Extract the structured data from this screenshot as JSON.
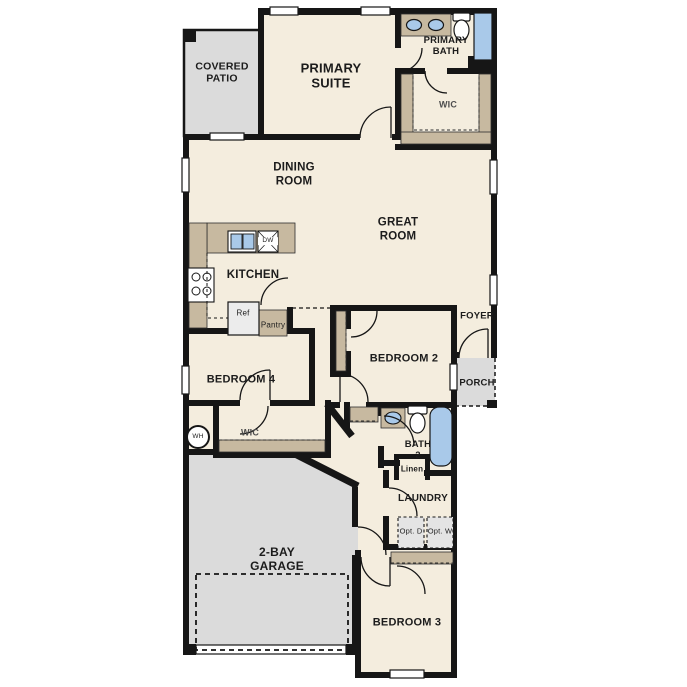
{
  "plan": {
    "title": "single-story-floor-plan",
    "rooms": {
      "covered_patio": "COVERED PATIO",
      "primary_suite": "PRIMARY SUITE",
      "primary_bath": "PRIMARY BATH",
      "primary_wic": "WIC",
      "dining_room": "DINING ROOM",
      "great_room": "GREAT ROOM",
      "kitchen": "KITCHEN",
      "foyer": "FOYER",
      "porch": "PORCH",
      "bedroom_2": "BEDROOM 2",
      "bedroom_4": "BEDROOM 4",
      "bedroom4_wic": "WIC",
      "bath_2": "BATH 2",
      "linen": "Linen",
      "laundry": "LAUNDRY",
      "garage": "2-BAY GARAGE",
      "bedroom_3": "BEDROOM 3"
    },
    "fixtures": {
      "ref": "Ref",
      "pantry": "Pantry",
      "dishwasher": "DW",
      "water_heater": "WH",
      "opt_dryer": "Opt. D",
      "opt_washer": "Opt. W"
    },
    "colors": {
      "floor": "#f4edde",
      "outdoor": "#dbdbdb",
      "cabinet": "#c7b9a0",
      "fixture_blue": "#a9c9e9",
      "wall": "#161616",
      "appliance": "#ececec"
    }
  }
}
